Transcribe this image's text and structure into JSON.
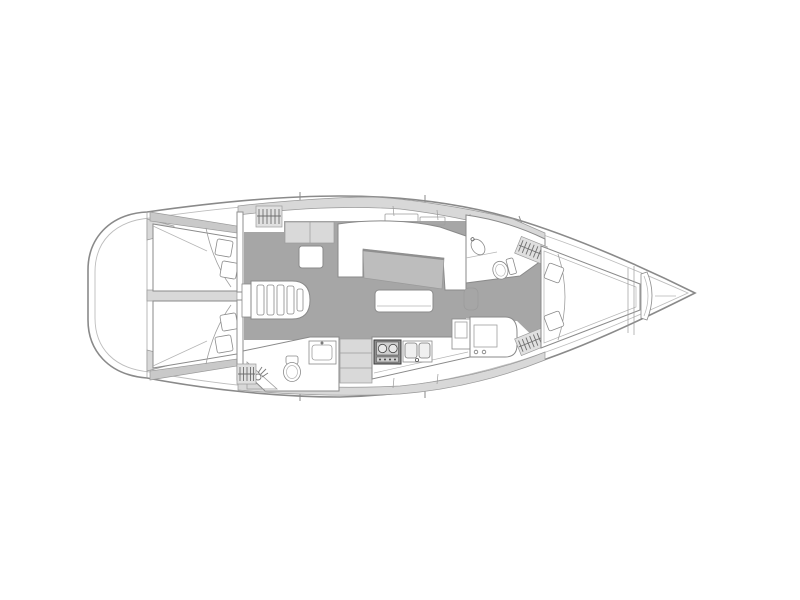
{
  "diagram": {
    "title": "Sailing yacht interior layout plan (top view)",
    "type": "boat-floor-plan",
    "orientation": "bow-right-stern-left",
    "regions": [
      "aft-cabin-port",
      "aft-cabin-starboard",
      "companionway-steps",
      "salon-u-settee",
      "salon-table",
      "salon-bench",
      "cabinet",
      "stool",
      "aft-head-with-toilet-and-shower",
      "galley-stove",
      "galley-double-sink",
      "galley-refrigerator",
      "forward-head-with-toilet-and-sink",
      "hanging-locker-1",
      "hanging-locker-2",
      "hanging-locker-3",
      "hanging-locker-4",
      "v-berth-forward-cabin",
      "anchor-locker",
      "transom-swim-platform"
    ]
  },
  "colors": {
    "hull_line": "#8a8a8a",
    "deck": "#d8d8d8",
    "floor": "#a6a6a6",
    "band": "#c9c9c9",
    "table": "#bdbdbd",
    "cabinet": "#d9d9d9",
    "locker": "#e0e0e0",
    "stove": "#8f8f8f",
    "white": "#ffffff"
  }
}
